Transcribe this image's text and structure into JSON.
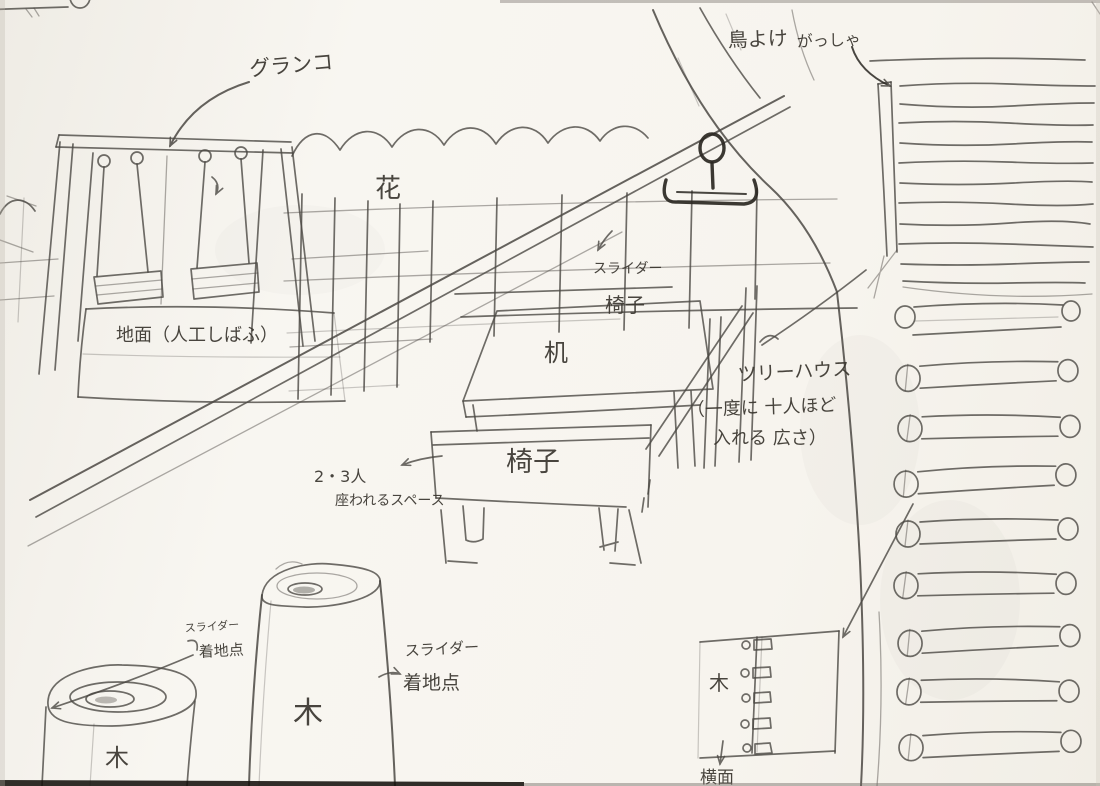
{
  "sketch": {
    "labels": {
      "swing": "グランコ",
      "flower": "花",
      "bird_guard": "鳥よけ",
      "pulley": "がっしゃ",
      "slider": "スライダー",
      "chair": "椅子",
      "desk": "机",
      "treehouse": "ツリーハウス",
      "capacity_line1": "（一度に 十人ほど",
      "capacity_line2": "入れる 広さ）",
      "seating_line1": "2・3人",
      "seating_line2": "座われるスペース",
      "ground": "地面（人工しばふ）",
      "landing_point": "着地点",
      "tree": "木",
      "side_view": "横面"
    },
    "colors": {
      "pencil": "#4b4843",
      "dark_pencil": "#2a2722",
      "paper": "#f7f4ee",
      "ink": "#3a362f"
    }
  }
}
